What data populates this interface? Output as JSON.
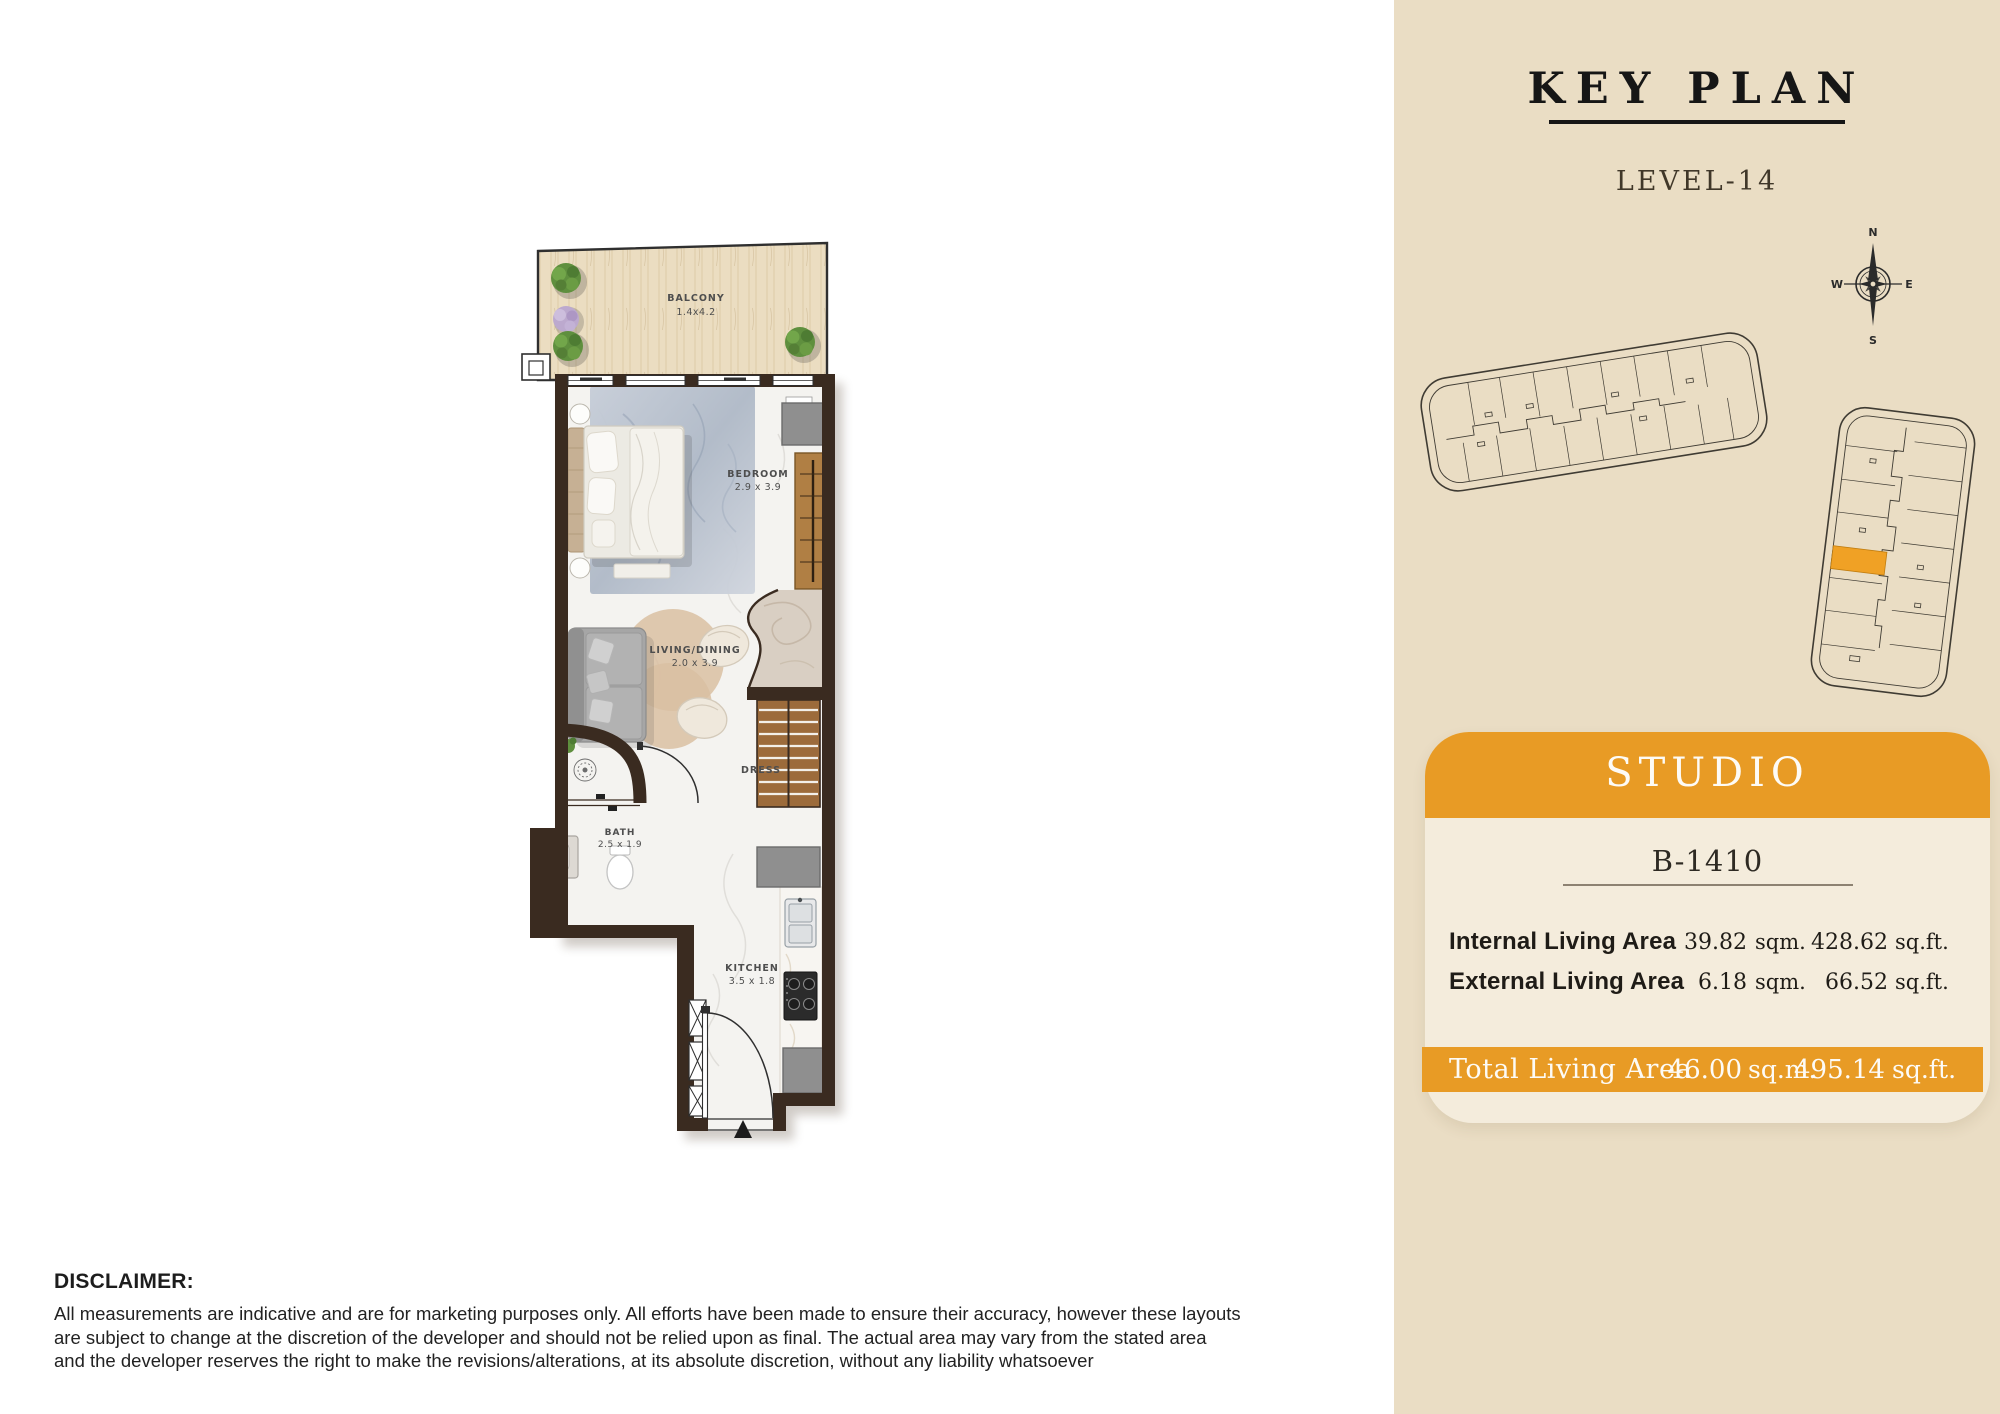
{
  "floorplan": {
    "balcony": {
      "label": "BALCONY",
      "dims": "1.4x4.2"
    },
    "bedroom": {
      "label": "BEDROOM",
      "dims": "2.9 x 3.9"
    },
    "living": {
      "label": "LIVING/DINING",
      "dims": "2.0 x 3.9"
    },
    "dress": {
      "label": "DRESS"
    },
    "bath": {
      "label": "BATH",
      "dims": "2.5 x 1.9"
    },
    "kitchen": {
      "label": "KITCHEN",
      "dims": "3.5 x 1.8"
    }
  },
  "key_plan": {
    "title": "KEY PLAN",
    "level": "LEVEL-14",
    "compass": {
      "n": "N",
      "s": "S",
      "e": "E",
      "w": "W"
    }
  },
  "unit_card": {
    "type_label": "STUDIO",
    "unit_number": "B-1410",
    "rows": [
      {
        "label": "Internal Living Area",
        "sqm": "39.82",
        "sqm_unit": "sqm.",
        "sqft": "428.62",
        "sqft_unit": "sq.ft."
      },
      {
        "label": "External Living Area",
        "sqm": "6.18",
        "sqm_unit": "sqm.",
        "sqft": "66.52",
        "sqft_unit": "sq.ft."
      }
    ],
    "total": {
      "label": "Total Living Area",
      "sqm": "46.00",
      "sqm_unit": "sq.m.",
      "sqft": "495.14",
      "sqft_unit": "sq.ft."
    }
  },
  "disclaimer": {
    "heading": "DISCLAIMER:",
    "lines": [
      "All measurements are indicative and are for marketing purposes only. All efforts have been made to ensure their accuracy, however these layouts",
      "are subject to change at the discretion of the developer and should not be relied upon as final. The actual area may vary from the stated area",
      "and the developer reserves the right to make the revisions/alterations, at its absolute discretion, without any liability whatsoever"
    ]
  },
  "colors": {
    "accent_orange": "#E89B25",
    "highlight_unit_orange": "#F0A125",
    "panel_beige": "#EADDC4",
    "card_beige": "#F4ECDC",
    "wall_brown": "#3A2B20",
    "balcony_wood": "#EBDDC1",
    "title_ink": "#161616"
  }
}
